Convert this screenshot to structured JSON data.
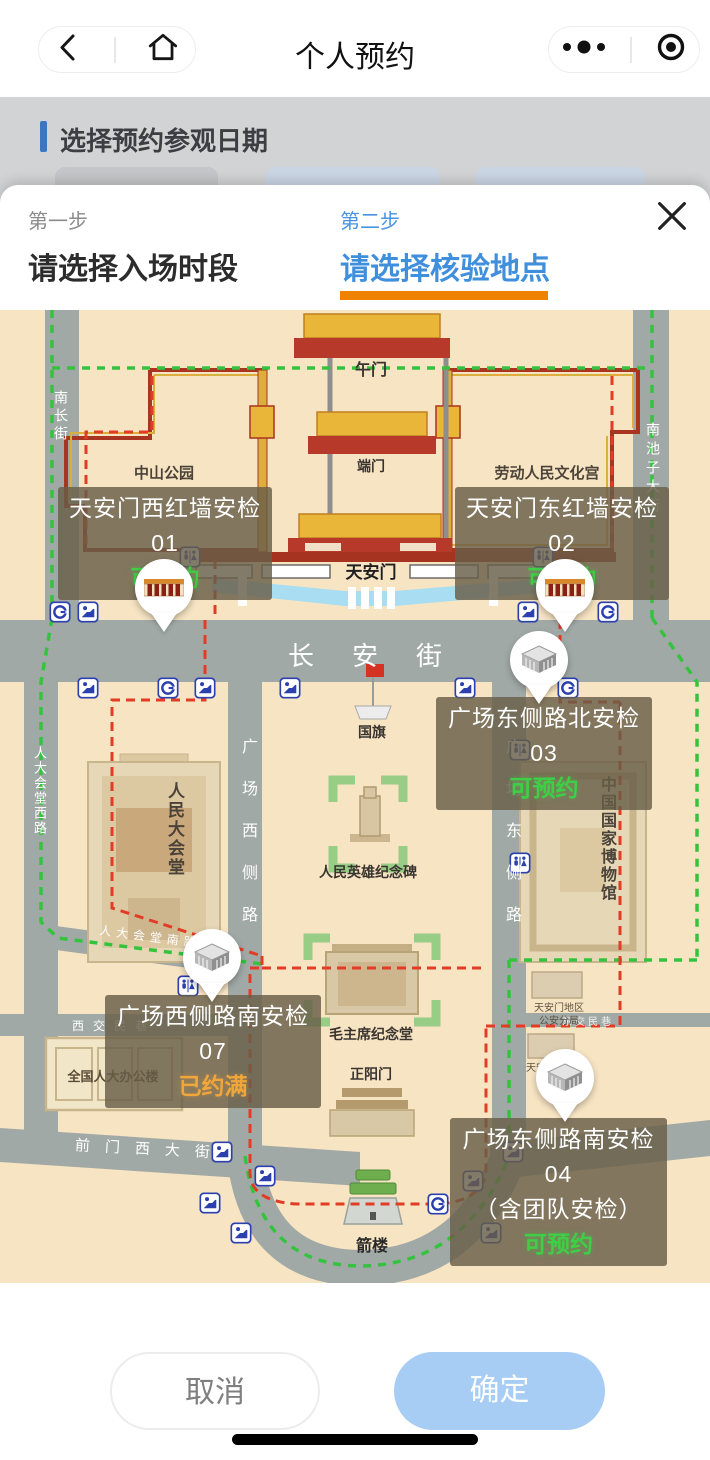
{
  "navbar": {
    "title": "个人预约"
  },
  "underlay": {
    "section_title": "选择预约参观日期"
  },
  "modal": {
    "steps": [
      {
        "step": "第一步",
        "title": "请选择入场时段",
        "active": false
      },
      {
        "step": "第二步",
        "title": "请选择核验地点",
        "active": true
      }
    ],
    "footer": {
      "cancel": "取消",
      "confirm": "确定"
    }
  },
  "map": {
    "labels": {
      "wumen": "午门",
      "duanmen": "端门",
      "tiananmen": "天安门",
      "zhongshan_park": "中山公园",
      "cultural_palace": "劳动人民文化宫",
      "nanchang_st": "南长街",
      "nanchizi_st": "南池子大街",
      "changan_st": "长安街",
      "guoqi": "国旗",
      "great_hall": "人民大会堂",
      "renda_west_rd": "人大会堂西路",
      "monument": "人民英雄纪念碑",
      "national_museum": "中国国家博物馆",
      "gc_west_rd": "广场西侧路",
      "gc_east_rd": "广场东侧路",
      "mao_hall": "毛主席纪念堂",
      "zhengyangmen": "正阳门",
      "jianlou": "箭楼",
      "renda_office": "全国人大办公楼",
      "xijiaominxiang": "西交民巷",
      "dongjiaominxiang": "东交民巷",
      "qianmen_west_st": "前门西大街",
      "renda_south_rd": "人大会堂南路",
      "police_branch": "天安门地区公安分局",
      "admin_committee": "天安门地区管委会"
    },
    "checkpoints": [
      {
        "id": "01",
        "name": "天安门西红墙安检01",
        "status": "可预约",
        "available": true
      },
      {
        "id": "02",
        "name": "天安门东红墙安检02",
        "status": "可预约",
        "available": true
      },
      {
        "id": "03",
        "name": "广场东侧路北安检03",
        "status": "可预约",
        "available": true
      },
      {
        "id": "07",
        "name": "广场西侧路南安检07",
        "status": "已约满",
        "available": false
      },
      {
        "id": "04",
        "name": "广场东侧路南安检04",
        "subtitle": "（含团队安检）",
        "status": "可预约",
        "available": true
      }
    ]
  },
  "colors": {
    "step_active_blue": "#3f8fdd",
    "step_underline_orange": "#ef8200",
    "available_green": "#3fcf46",
    "full_orange": "#f0a63a",
    "confirm_button_blue": "#a7cdf4",
    "tooltip_bg": "rgba(104,94,72,0.82)",
    "map_background": "#f7e4c3",
    "road_gray": "#a1a9a6"
  }
}
